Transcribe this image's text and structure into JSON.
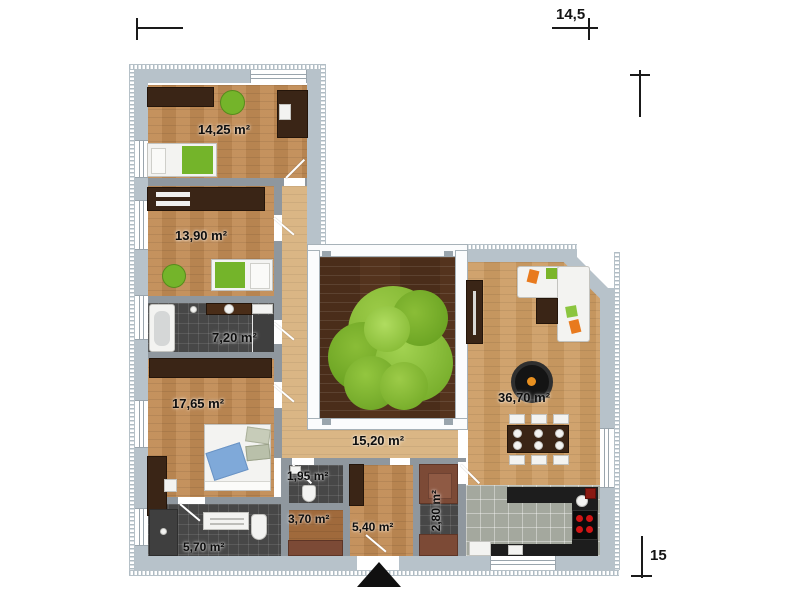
{
  "plan": {
    "rooms": [
      {
        "area": "14,25 m²"
      },
      {
        "area": "13,90 m²"
      },
      {
        "area": "7,20 m²"
      },
      {
        "area": "17,65 m²"
      },
      {
        "area": "15,20 m²"
      },
      {
        "area": "36,70 m²"
      },
      {
        "area": "1,95 m²"
      },
      {
        "area": "3,70 m²"
      },
      {
        "area": "5,40 m²"
      },
      {
        "area": "2,80 m²"
      },
      {
        "area": "5,70 m²"
      }
    ],
    "dimensions": {
      "width": "14,5",
      "height": "15"
    },
    "colors": {
      "exterior_wall": "#b7c2ca",
      "interior_wall": "#8f979e",
      "wood_floor": "#c18b54",
      "hall_floor": "#dab685",
      "deck": "#54331d",
      "tree": "#7db32c",
      "dark_furniture": "#3a2516",
      "accent_green": "#74b42a",
      "dark_tile": "#474747",
      "light_tile": "#a4a89e",
      "counter_black": "#1d1d1d",
      "label_text": "#111111"
    }
  }
}
